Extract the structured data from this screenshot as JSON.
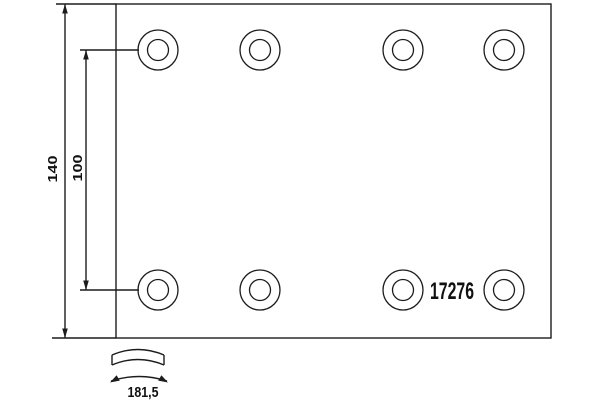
{
  "document": {
    "description": "Technical drawing of a rectangular brake lining plate with two rows of rivet holes, dimension callouts and an arc profile detail"
  },
  "labels": {
    "part_number": "17276",
    "overall_height": "140",
    "hole_row_spacing": "100",
    "arc_width": "181,5"
  },
  "drawing": {
    "plate": {
      "x": 116,
      "y": 4,
      "width": 435,
      "height": 334
    },
    "holes": {
      "outer_radius": 20,
      "inner_radius": 10.5,
      "columns_x": [
        158,
        260,
        403,
        504
      ],
      "rows_y": [
        50,
        290
      ]
    },
    "colors": {
      "line": "#1c1c1c",
      "background": "#ffffff",
      "text": "#111111"
    }
  }
}
